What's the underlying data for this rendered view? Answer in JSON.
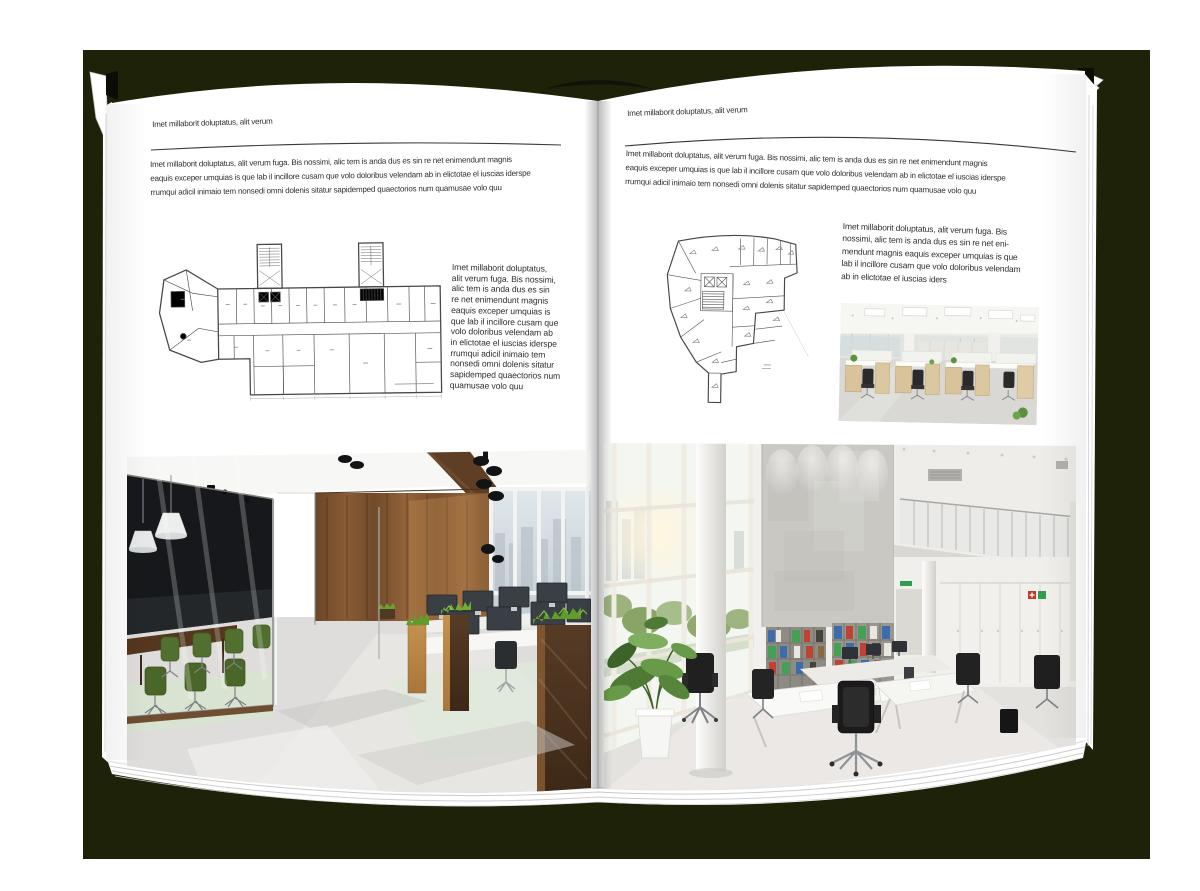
{
  "colors": {
    "backdrop": "#1e2209",
    "page": "#ffffff",
    "rule": "#3a3a3a",
    "text": "#2f2f2f"
  },
  "left_page": {
    "header": "Imet millaborit doluptatus, alit verum",
    "body": "Imet millaborit doluptatus, alit verum fuga. Bis nossimi, alic tem is anda dus es sin re net enimendunt magnis\neaquis exceper umquias is que lab il incillore cusam que volo doloribus velendam ab in elictotae el iuscias iderspe\nrrumqui adicil inimaio tem nonsedi omni dolenis sitatur sapidemped quaectorios num quamusae volo quu",
    "side_text": "Imet millaborit doluptatus,\nalit verum fuga. Bis nossimi,\nalic tem is anda dus es sin\nre net enimendunt magnis\neaquis exceper umquias is\nque lab il incillore cusam que\nvolo doloribus velendam ab\nin elictotae el iuscias iderspe\nrrumqui adicil inimaio tem\nnonsedi omni dolenis sitatur\nsapidemped quaectorios num\nquamusae volo quu"
  },
  "right_page": {
    "header": "Imet millaborit doluptatus, alit verum",
    "body": "Imet millaborit doluptatus, alit verum fuga. Bis nossimi, alic tem is anda dus es sin re net enimendunt magnis\neaquis exceper umquias is que lab il incillore cusam que volo doloribus velendam ab in elictotae el iuscias iderspe\nrrumqui adicil inimaio tem nonsedi omni dolenis sitatur sapidemped quaectorios num quamusae volo quu",
    "side_text": "Imet millaborit doluptatus, alit verum fuga. Bis\nnossimi, alic tem is anda dus es sin re net eni-\nmendunt magnis eaquis exceper umquias is que\nlab il incillore cusam que volo doloribus velendam\nab in elictotae el iuscias iders"
  }
}
